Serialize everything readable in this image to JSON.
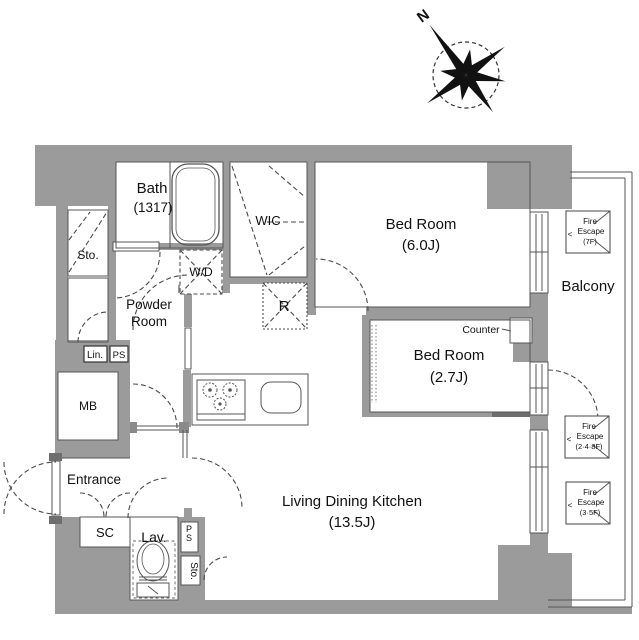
{
  "plan": {
    "compass": {
      "north_label": "N"
    },
    "rooms": {
      "bath": {
        "name": "Bath",
        "size": "(1317)"
      },
      "wic": {
        "name": "WIC"
      },
      "powder": {
        "name_line1": "Powder",
        "name_line2": "Room"
      },
      "bedroom1": {
        "name": "Bed Room",
        "size": "(6.0J)"
      },
      "bedroom2": {
        "name": "Bed Room",
        "size": "(2.7J)"
      },
      "ldk": {
        "name": "Living Dining Kitchen",
        "size": "(13.5J)"
      },
      "entrance": {
        "name": "Entrance"
      },
      "lavatory": {
        "name": "Lav."
      },
      "balcony": {
        "name": "Balcony"
      }
    },
    "labels": {
      "storage_upper": "Sto.",
      "washer_dryer": "W/D",
      "refrigerator": "R",
      "linen": "Lin.",
      "pipe_space_upper": "PS",
      "meter_box": "MB",
      "shoe_closet": "SC",
      "pipe_space_lower": "PS",
      "storage_lower": "Sto.",
      "counter": "Counter",
      "escape_arrow": "<"
    },
    "fire_escapes": [
      {
        "line1": "Fire",
        "line2": "Escape",
        "line3": "(7F)"
      },
      {
        "line1": "Fire",
        "line2": "Escape",
        "line3": "(2·4·8F)"
      },
      {
        "line1": "Fire",
        "line2": "Escape",
        "line3": "(3·5F)"
      }
    ],
    "colors": {
      "wall": "#9b9b9b",
      "line": "#555555",
      "text": "#111111"
    }
  }
}
